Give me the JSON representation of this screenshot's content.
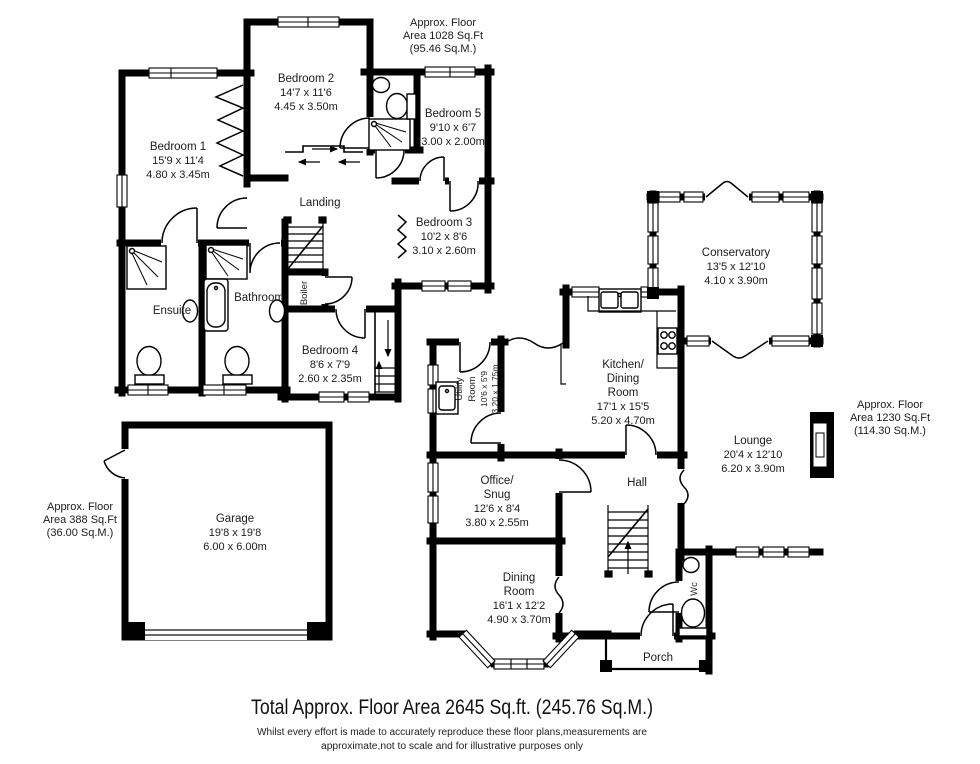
{
  "rooms": {
    "bedroom1": {
      "lines": [
        "Bedroom 1",
        "15'9 x 11'4",
        "4.80 x 3.45m"
      ]
    },
    "bedroom2": {
      "lines": [
        "Bedroom 2",
        "14'7 x 11'6",
        "4.45 x 3.50m"
      ]
    },
    "bedroom3": {
      "lines": [
        "Bedroom 3",
        "10'2 x 8'6",
        "3.10 x 2.60m"
      ]
    },
    "bedroom4": {
      "lines": [
        "Bedroom 4",
        "8'6 x 7'9",
        "2.60 x 2.35m"
      ]
    },
    "bedroom5": {
      "lines": [
        "Bedroom 5",
        "9'10 x 6'7",
        "3.00 x 2.00m"
      ]
    },
    "landing": {
      "lines": [
        "Landing"
      ]
    },
    "bathroom": {
      "lines": [
        "Bathroom"
      ]
    },
    "ensuite": {
      "lines": [
        "Ensuite"
      ]
    },
    "boiler": {
      "lines": [
        "Boiler"
      ]
    },
    "conservatory": {
      "lines": [
        "Conservatory",
        "13'5 x 12'10",
        "4.10 x 3.90m"
      ]
    },
    "kitchen": {
      "lines": [
        "Kitchen/",
        "Dining",
        "Room",
        "17'1 x 15'5",
        "5.20 x 4.70m"
      ]
    },
    "lounge": {
      "lines": [
        "Lounge",
        "20'4 x 12'10",
        "6.20 x 3.90m"
      ]
    },
    "utility": {
      "lines": [
        "Utility",
        "Room",
        "10'6 x 5'9",
        "3.20 x 1.75m"
      ]
    },
    "office": {
      "lines": [
        "Office/",
        "Snug",
        "12'6 x 8'4",
        "3.80 x 2.55m"
      ]
    },
    "hall": {
      "lines": [
        "Hall"
      ]
    },
    "dining": {
      "lines": [
        "Dining",
        "Room",
        "16'1 x 12'2",
        "4.90 x 3.70m"
      ]
    },
    "wc": {
      "lines": [
        "Wc"
      ]
    },
    "porch": {
      "lines": [
        "Porch"
      ]
    },
    "garage": {
      "lines": [
        "Garage",
        "19'8 x 19'8",
        "6.00 x 6.00m"
      ]
    }
  },
  "area_labels": {
    "first_floor": {
      "lines": [
        "Approx. Floor",
        "Area 1028 Sq.Ft",
        "(95.46 Sq.M.)"
      ]
    },
    "ground_floor": {
      "lines": [
        "Approx. Floor",
        "Area 1230 Sq.Ft",
        "(114.30 Sq.M.)"
      ]
    },
    "garage": {
      "lines": [
        "Approx. Floor",
        "Area 388 Sq.Ft",
        "(36.00 Sq.M.)"
      ]
    }
  },
  "footer": {
    "total": "Total Approx. Floor Area 2645 Sq.ft. (245.76 Sq.M.)",
    "disclaimer1": "Whilst every effort is made to accurately reproduce these floor plans,measurements are",
    "disclaimer2": "approximate,not to scale and for illustrative purposes only"
  },
  "colors": {
    "wall": "#000000",
    "text": "#1b1b1b",
    "background": "#ffffff"
  }
}
